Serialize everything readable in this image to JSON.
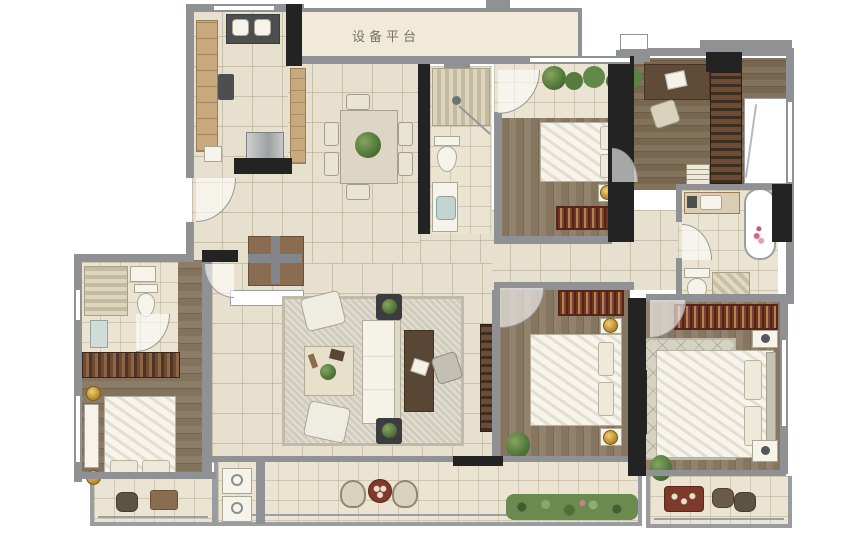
{
  "floorplan": {
    "labels": {
      "equipment_platform": "设备平台"
    },
    "colors": {
      "wall_dark": "#232323",
      "wall_gray": "#8f9194",
      "tile_floor": "#e8e0ce",
      "balcony_floor": "#ece4d2",
      "wood_floor": "#87765f",
      "counter_wood": "#c9a87d",
      "rug_red": "#7e4030",
      "rug_light": "#d2ccbc",
      "plant_green": "#527539",
      "bath_water_blue": "#aed6e0",
      "lamp_gold": "#c29435",
      "furniture_white": "#f6f3ea"
    }
  }
}
